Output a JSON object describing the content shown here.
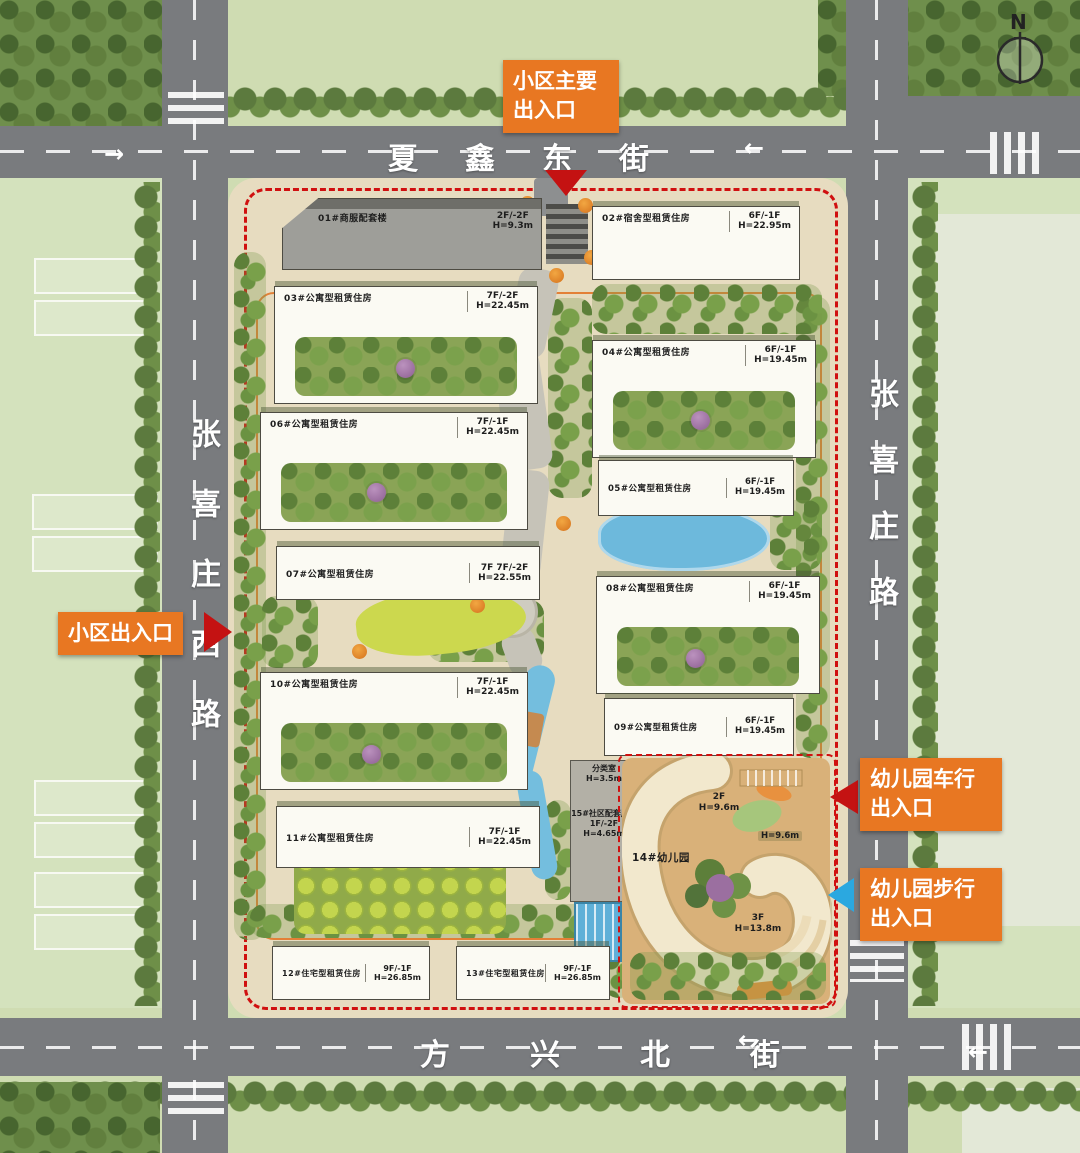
{
  "north_label": "N",
  "streets": {
    "top": "夏鑫东街",
    "bottom": "方兴北街",
    "left": "张喜庄西路",
    "right": "张喜庄路"
  },
  "callouts": {
    "main_entrance": "小区主要出入口",
    "side_entrance": "小区出入口",
    "kg_car_entrance": "幼儿园车行出入口",
    "kg_walk_entrance": "幼儿园步行出入口"
  },
  "buildings": {
    "b01": {
      "name": "01#商服配套楼",
      "floors": "2F/-2F",
      "height": "H=9.3m"
    },
    "b02": {
      "name": "02#宿舍型租赁住房",
      "floors": "6F/-1F",
      "height": "H=22.95m"
    },
    "b03": {
      "name": "03#公寓型租赁住房",
      "floors": "7F/-2F",
      "height": "H=22.45m"
    },
    "b04": {
      "name": "04#公寓型租赁住房",
      "floors": "6F/-1F",
      "height": "H=19.45m"
    },
    "b05": {
      "name": "05#公寓型租赁住房",
      "floors": "6F/-1F",
      "height": "H=19.45m"
    },
    "b06": {
      "name": "06#公寓型租赁住房",
      "floors": "7F/-1F",
      "height": "H=22.45m"
    },
    "b07": {
      "name": "07#公寓型租赁住房",
      "floors": "7F 7F/-2F",
      "height": "H=22.55m"
    },
    "b08": {
      "name": "08#公寓型租赁住房",
      "floors": "6F/-1F",
      "height": "H=19.45m"
    },
    "b09": {
      "name": "09#公寓型租赁住房",
      "floors": "6F/-1F",
      "height": "H=19.45m"
    },
    "b10": {
      "name": "10#公寓型租赁住房",
      "floors": "7F/-1F",
      "height": "H=22.45m"
    },
    "b11": {
      "name": "11#公寓型租赁住房",
      "floors": "7F/-1F",
      "height": "H=22.45m"
    },
    "b12": {
      "name": "12#住宅型租赁住房",
      "floors": "9F/-1F",
      "height": "H=26.85m"
    },
    "b13": {
      "name": "13#住宅型租赁住房",
      "floors": "9F/-1F",
      "height": "H=26.85m"
    },
    "b15": {
      "name": "15#社区配套用房",
      "floors": "1F/-2F",
      "height": "H=4.65m"
    },
    "aux": {
      "name": "分类室",
      "height": "H=3.5m"
    }
  },
  "kindergarten": {
    "name": "14#幼儿园",
    "wing_a": {
      "floors": "2F",
      "height": "H=9.6m"
    },
    "wing_b": {
      "height": "H=9.6m"
    },
    "wing_c": {
      "floors": "3F",
      "height": "H=13.8m"
    }
  },
  "colors": {
    "callout_orange": "#E87722",
    "boundary_red": "#D01010",
    "walk_blue": "#2BA8E0",
    "road_gray": "#797B7E",
    "site_beige": "#E7DCC0"
  }
}
